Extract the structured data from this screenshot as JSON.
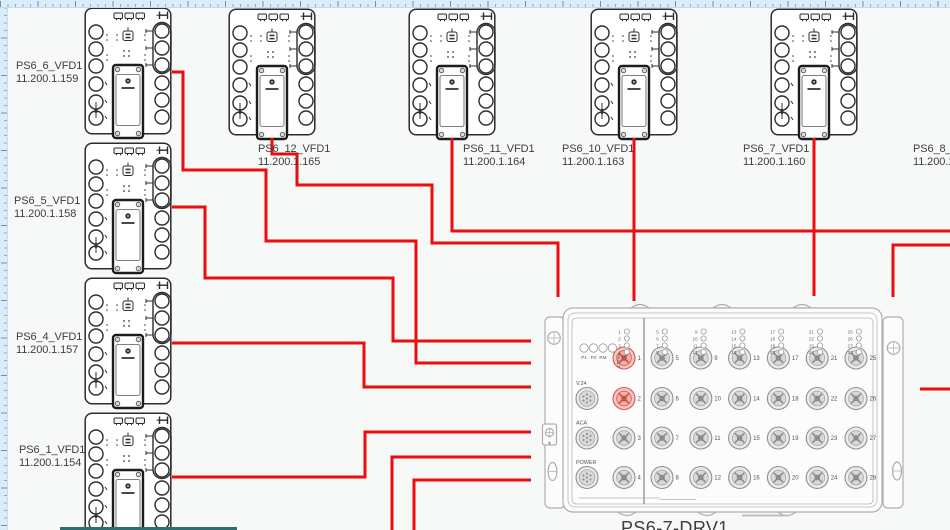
{
  "app": {
    "canvas_color": "#f7f8f8",
    "ruler_color": "#daecf8",
    "taskbar_strip_color": "#2e6e6e"
  },
  "colors": {
    "cable": "#ec0d0d",
    "highlight_port": "#d0584e",
    "device_outline": "#2c2c2c",
    "box_outline": "#aeaeae"
  },
  "devices": [
    {
      "name": "PS6_6_VFD1",
      "ip": "11.200.1.159",
      "x": 84,
      "y": 7,
      "label_x": 16,
      "label_y": 60
    },
    {
      "name": "PS6_5_VFD1",
      "ip": "11.200.1.158",
      "x": 84,
      "y": 142,
      "label_x": 14,
      "label_y": 195
    },
    {
      "name": "PS6_4_VFD1",
      "ip": "11.200.1.157",
      "x": 84,
      "y": 277,
      "label_x": 16,
      "label_y": 331
    },
    {
      "name": "PS6_1_VFD1",
      "ip": "11.200.1.154",
      "x": 84,
      "y": 412,
      "label_x": 19,
      "label_y": 444
    },
    {
      "name": "PS6_12_VFD1",
      "ip": "11.200.1.165",
      "x": 228,
      "y": 8,
      "label_x": 258,
      "label_y": 143
    },
    {
      "name": "PS6_11_VFD1",
      "ip": "11.200.1.164",
      "x": 408,
      "y": 8,
      "label_x": 463,
      "label_y": 143
    },
    {
      "name": "PS6_10_VFD1",
      "ip": "11.200.1.163",
      "x": 590,
      "y": 8,
      "label_x": 562,
      "label_y": 143
    },
    {
      "name": "PS6_7_VFD1",
      "ip": "11.200.1.160",
      "x": 770,
      "y": 8,
      "label_x": 743,
      "label_y": 143
    },
    {
      "name": "PS6_8_VF",
      "ip": "11.200.1.",
      "x": null,
      "y": null,
      "label_x": 913,
      "label_y": 143
    }
  ],
  "switch_box": {
    "name": "PS6-7-DRV1",
    "status_leds": [
      "P1",
      "P2",
      "RM",
      "FAULT"
    ],
    "aux_ports": [
      "V.24",
      "ACA",
      "POWER"
    ],
    "data_ports": {
      "count": 28,
      "highlighted": [
        1,
        2
      ]
    }
  },
  "cables": [
    {
      "from": "PS6_6_VFD1",
      "points": [
        [
          172,
          72
        ],
        [
          183,
          72
        ],
        [
          183,
          170
        ],
        [
          266,
          170
        ],
        [
          266,
          241
        ],
        [
          416,
          241
        ],
        [
          416,
          363
        ],
        [
          531,
          363
        ]
      ]
    },
    {
      "from": "PS6_5_VFD1",
      "points": [
        [
          172,
          207
        ],
        [
          205,
          207
        ],
        [
          205,
          278
        ],
        [
          393,
          278
        ],
        [
          393,
          341
        ],
        [
          531,
          341
        ]
      ]
    },
    {
      "from": "PS6_4_VFD1",
      "points": [
        [
          172,
          343
        ],
        [
          364,
          343
        ],
        [
          364,
          387
        ],
        [
          531,
          387
        ]
      ]
    },
    {
      "from": "PS6_1_VFD1",
      "points": [
        [
          172,
          477
        ],
        [
          365,
          477
        ],
        [
          365,
          432
        ],
        [
          531,
          432
        ]
      ]
    },
    {
      "from": "offscreen-bottom-a",
      "points": [
        [
          392,
          532
        ],
        [
          392,
          457
        ],
        [
          531,
          457
        ]
      ]
    },
    {
      "from": "offscreen-bottom-b",
      "points": [
        [
          414,
          532
        ],
        [
          414,
          480
        ],
        [
          531,
          480
        ]
      ]
    },
    {
      "from": "PS6_12_VFD1",
      "points": [
        [
          272,
          138
        ],
        [
          272,
          154
        ],
        [
          297,
          154
        ],
        [
          297,
          185
        ],
        [
          432,
          185
        ],
        [
          432,
          243
        ],
        [
          558,
          243
        ],
        [
          558,
          297
        ]
      ]
    },
    {
      "from": "PS6_11_VFD1",
      "points": [
        [
          452,
          138
        ],
        [
          452,
          231
        ],
        [
          952,
          231
        ]
      ]
    },
    {
      "from": "PS6_10_VFD1",
      "points": [
        [
          634,
          138
        ],
        [
          634,
          301
        ]
      ]
    },
    {
      "from": "PS6_7_VFD1",
      "points": [
        [
          814,
          138
        ],
        [
          814,
          296
        ]
      ]
    },
    {
      "from": "offscreen-right-a",
      "points": [
        [
          952,
          245
        ],
        [
          893,
          245
        ],
        [
          893,
          297
        ]
      ]
    },
    {
      "from": "offscreen-right-b",
      "points": [
        [
          952,
          389
        ],
        [
          920,
          389
        ]
      ]
    }
  ]
}
